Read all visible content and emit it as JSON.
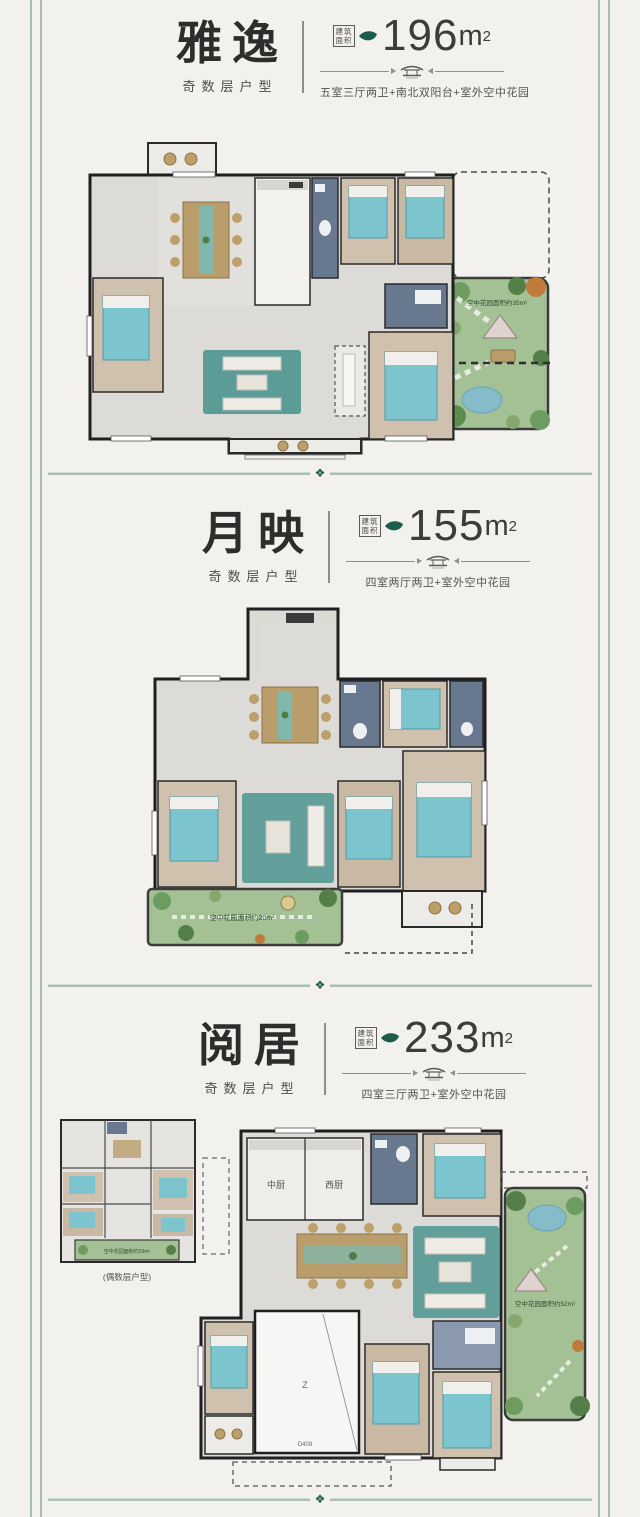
{
  "colors": {
    "accent_green": "#1d5c4a",
    "frame_teal": "#a9bcb5",
    "garden_green": "#a4c195",
    "bed_teal": "#7cc5cf",
    "wall": "#1f1f1f"
  },
  "divider": {
    "gem": "❖"
  },
  "sections": [
    {
      "title": "雅逸",
      "subtitle": "奇数层户型",
      "badge1": "建筑",
      "badge2": "面积",
      "area_value": "196",
      "area_unit": "m",
      "area_sup": "2",
      "features": "五室三厅两卫+南北双阳台+室外空中花园",
      "garden_label": "空中花园面积约35m²"
    },
    {
      "title": "月映",
      "subtitle": "奇数层户型",
      "badge1": "建筑",
      "badge2": "面积",
      "area_value": "155",
      "area_unit": "m",
      "area_sup": "2",
      "features": "四室两厅两卫+室外空中花园",
      "garden_label": "空中花园面积约20m²"
    },
    {
      "title": "阅居",
      "subtitle": "奇数层户型",
      "badge1": "建筑",
      "badge2": "面积",
      "area_value": "233",
      "area_unit": "m",
      "area_sup": "2",
      "features": "四室三厅两卫+室外空中花园",
      "garden_label": "空中花园面积约52m²",
      "kitchen_cn": "中厨",
      "kitchen_west": "西厨",
      "void_label": "Z",
      "door_label": "D409",
      "inset_caption": "(偶数层户型)",
      "inset_garden_label": "空中花园面积约29m²"
    }
  ]
}
